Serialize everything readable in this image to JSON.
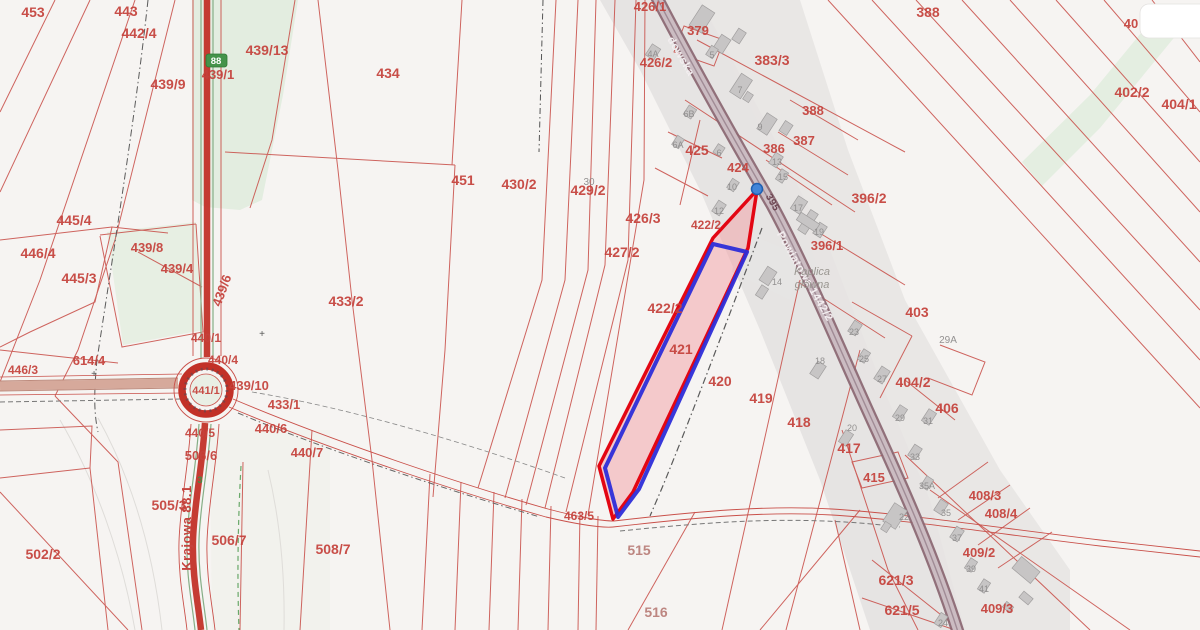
{
  "map": {
    "colors": {
      "background": "#f6f4f2",
      "parcel_line": "#c9504a",
      "parcel_text": "#c5423c",
      "road_red": "#c23128",
      "road_purple_casing": "#8a6671",
      "road_purple_fill": "#cbbcc2",
      "green_area": "#e3ede0",
      "settlement_gray": "#e6e4e3",
      "building_gray": "#c7c5c5",
      "highlight_fill": "#f29da4",
      "highlight_red": "#e30613",
      "highlight_blue": "#2d2dd8",
      "marker_blue": "#4285d8",
      "badge_green": "#44934a"
    },
    "parcel_labels": [
      {
        "t": "453",
        "x": 33,
        "y": 17
      },
      {
        "t": "443",
        "x": 126,
        "y": 16
      },
      {
        "t": "442/4",
        "x": 139,
        "y": 38
      },
      {
        "t": "439/9",
        "x": 168,
        "y": 89
      },
      {
        "t": "439/1",
        "x": 218,
        "y": 79,
        "s": 13
      },
      {
        "t": "439/13",
        "x": 267,
        "y": 55
      },
      {
        "t": "434",
        "x": 388,
        "y": 78
      },
      {
        "t": "426/1",
        "x": 650,
        "y": 11,
        "s": 13
      },
      {
        "t": "426/2",
        "x": 656,
        "y": 67,
        "s": 13
      },
      {
        "t": "379",
        "x": 698,
        "y": 35,
        "s": 13
      },
      {
        "t": "383/3",
        "x": 772,
        "y": 65
      },
      {
        "t": "388",
        "x": 928,
        "y": 17
      },
      {
        "t": "388",
        "x": 813,
        "y": 115,
        "s": 13
      },
      {
        "t": "387",
        "x": 804,
        "y": 145,
        "s": 13
      },
      {
        "t": "386",
        "x": 774,
        "y": 153,
        "s": 13
      },
      {
        "t": "425",
        "x": 697,
        "y": 155
      },
      {
        "t": "424",
        "x": 738,
        "y": 172,
        "s": 13
      },
      {
        "t": "396/2",
        "x": 869,
        "y": 203
      },
      {
        "t": "396/1",
        "x": 827,
        "y": 250,
        "s": 13
      },
      {
        "t": "403",
        "x": 917,
        "y": 317
      },
      {
        "t": "404/2",
        "x": 913,
        "y": 387
      },
      {
        "t": "406",
        "x": 947,
        "y": 413
      },
      {
        "t": "402/2",
        "x": 1132,
        "y": 97
      },
      {
        "t": "404/1",
        "x": 1179,
        "y": 109
      },
      {
        "t": "40",
        "x": 1131,
        "y": 28,
        "s": 13
      },
      {
        "t": "451",
        "x": 463,
        "y": 185
      },
      {
        "t": "430/2",
        "x": 519,
        "y": 189
      },
      {
        "t": "429/2",
        "x": 588,
        "y": 195
      },
      {
        "t": "426/3",
        "x": 643,
        "y": 223
      },
      {
        "t": "427/2",
        "x": 622,
        "y": 257
      },
      {
        "t": "422/2",
        "x": 665,
        "y": 313
      },
      {
        "t": "422/2",
        "x": 706,
        "y": 229,
        "s": 12
      },
      {
        "t": "421",
        "x": 681,
        "y": 354
      },
      {
        "t": "420",
        "x": 720,
        "y": 386
      },
      {
        "t": "419",
        "x": 761,
        "y": 403
      },
      {
        "t": "418",
        "x": 799,
        "y": 427
      },
      {
        "t": "433/2",
        "x": 346,
        "y": 306
      },
      {
        "t": "433/1",
        "x": 284,
        "y": 409,
        "s": 13
      },
      {
        "t": "439/10",
        "x": 249,
        "y": 390,
        "s": 13
      },
      {
        "t": "440/4",
        "x": 223,
        "y": 364,
        "s": 12
      },
      {
        "t": "440/1",
        "x": 206,
        "y": 342,
        "s": 12
      },
      {
        "t": "441/1",
        "x": 206,
        "y": 394,
        "s": 11
      },
      {
        "t": "440/6",
        "x": 271,
        "y": 433,
        "s": 13
      },
      {
        "t": "440/7",
        "x": 307,
        "y": 457,
        "s": 13
      },
      {
        "t": "440/5",
        "x": 200,
        "y": 437,
        "s": 12
      },
      {
        "t": "446/3",
        "x": 23,
        "y": 374,
        "s": 12
      },
      {
        "t": "614/4",
        "x": 89,
        "y": 365,
        "s": 13
      },
      {
        "t": "445/4",
        "x": 74,
        "y": 225
      },
      {
        "t": "446/4",
        "x": 38,
        "y": 258
      },
      {
        "t": "445/3",
        "x": 79,
        "y": 283
      },
      {
        "t": "439/8",
        "x": 147,
        "y": 252,
        "s": 13
      },
      {
        "t": "439/4",
        "x": 177,
        "y": 273,
        "s": 13
      },
      {
        "t": "439/6",
        "x": 226,
        "y": 292,
        "s": 13,
        "r": -70
      },
      {
        "t": "502/2",
        "x": 43,
        "y": 559
      },
      {
        "t": "505/3",
        "x": 169,
        "y": 510
      },
      {
        "t": "506/6",
        "x": 201,
        "y": 460,
        "s": 13
      },
      {
        "t": "506/7",
        "x": 229,
        "y": 545
      },
      {
        "t": "508/7",
        "x": 333,
        "y": 554
      },
      {
        "t": "515",
        "x": 639,
        "y": 555,
        "c": "#b97e79"
      },
      {
        "t": "516",
        "x": 656,
        "y": 617,
        "c": "#b97e79"
      },
      {
        "t": "463/5",
        "x": 579,
        "y": 520,
        "s": 12
      },
      {
        "t": "417",
        "x": 849,
        "y": 453
      },
      {
        "t": "415",
        "x": 874,
        "y": 482,
        "s": 13
      },
      {
        "t": "408/3",
        "x": 985,
        "y": 500,
        "s": 13
      },
      {
        "t": "408/4",
        "x": 1001,
        "y": 518,
        "s": 13
      },
      {
        "t": "409/2",
        "x": 979,
        "y": 557,
        "s": 13
      },
      {
        "t": "409/3",
        "x": 997,
        "y": 613,
        "s": 13
      },
      {
        "t": "621/3",
        "x": 896,
        "y": 585
      },
      {
        "t": "621/5",
        "x": 902,
        "y": 615
      }
    ],
    "building_labels": [
      {
        "t": "4A",
        "x": 653,
        "y": 57
      },
      {
        "t": "5",
        "x": 712,
        "y": 58
      },
      {
        "t": "7",
        "x": 740,
        "y": 93
      },
      {
        "t": "9",
        "x": 760,
        "y": 130
      },
      {
        "t": "6B",
        "x": 689,
        "y": 117
      },
      {
        "t": "6A",
        "x": 678,
        "y": 148
      },
      {
        "t": "6",
        "x": 719,
        "y": 156
      },
      {
        "t": "13",
        "x": 777,
        "y": 165
      },
      {
        "t": "15",
        "x": 783,
        "y": 180
      },
      {
        "t": "17",
        "x": 798,
        "y": 211
      },
      {
        "t": "19",
        "x": 819,
        "y": 235
      },
      {
        "t": "12",
        "x": 719,
        "y": 214
      },
      {
        "t": "10",
        "x": 732,
        "y": 190
      },
      {
        "t": "14",
        "x": 777,
        "y": 285
      },
      {
        "t": "18",
        "x": 820,
        "y": 364
      },
      {
        "t": "23",
        "x": 854,
        "y": 335
      },
      {
        "t": "25",
        "x": 864,
        "y": 362
      },
      {
        "t": "27",
        "x": 882,
        "y": 382
      },
      {
        "t": "29",
        "x": 900,
        "y": 421
      },
      {
        "t": "31",
        "x": 928,
        "y": 424
      },
      {
        "t": "33",
        "x": 915,
        "y": 460
      },
      {
        "t": "35",
        "x": 946,
        "y": 516
      },
      {
        "t": "35A",
        "x": 927,
        "y": 489
      },
      {
        "t": "37",
        "x": 957,
        "y": 541
      },
      {
        "t": "39",
        "x": 971,
        "y": 572
      },
      {
        "t": "41",
        "x": 984,
        "y": 592
      },
      {
        "t": "22",
        "x": 904,
        "y": 520
      },
      {
        "t": "20",
        "x": 852,
        "y": 431
      },
      {
        "t": "24",
        "x": 943,
        "y": 626
      },
      {
        "t": "29A",
        "x": 948,
        "y": 343,
        "s": 10
      },
      {
        "t": "30",
        "x": 589,
        "y": 185,
        "s": 10
      }
    ],
    "street_labels": [
      {
        "t": "Krajowa 88.1",
        "x": 191,
        "y": 528,
        "r": -90,
        "c": "#c5423c",
        "s": 13
      },
      {
        "t": "dowska",
        "x": 678,
        "y": 58,
        "r": 60,
        "c": "#f3eef0",
        "s": 11
      },
      {
        "t": "Powiatowa 1442/2",
        "x": 802,
        "y": 278,
        "r": 60,
        "c": "#f3eef0",
        "s": 11
      },
      {
        "t": "395",
        "x": 770,
        "y": 204,
        "r": 60,
        "c": "#6d4652",
        "s": 10
      }
    ],
    "misc_labels": [
      {
        "t": "88",
        "x": 216,
        "y": 64,
        "c": "#ffffff",
        "s": 9.5,
        "b": 1,
        "n": "road-number-badge-text"
      },
      {
        "t": "3",
        "x": 200,
        "y": 483,
        "c": "#3f8f46",
        "s": 9,
        "b": 1,
        "n": "bridge-marker-text"
      },
      {
        "t": "Kaplica",
        "x": 812,
        "y": 275,
        "c": "#999690",
        "s": 11,
        "i": 1,
        "n": "place-name-line1"
      },
      {
        "t": "główna",
        "x": 812,
        "y": 288,
        "c": "#999690",
        "s": 11,
        "i": 1,
        "n": "place-name-line2"
      },
      {
        "t": "+",
        "x": 94,
        "y": 377,
        "c": "#555555",
        "s": 10,
        "n": "survey-cross"
      },
      {
        "t": "+",
        "x": 262,
        "y": 337,
        "c": "#555555",
        "s": 10,
        "n": "survey-cross"
      }
    ]
  }
}
